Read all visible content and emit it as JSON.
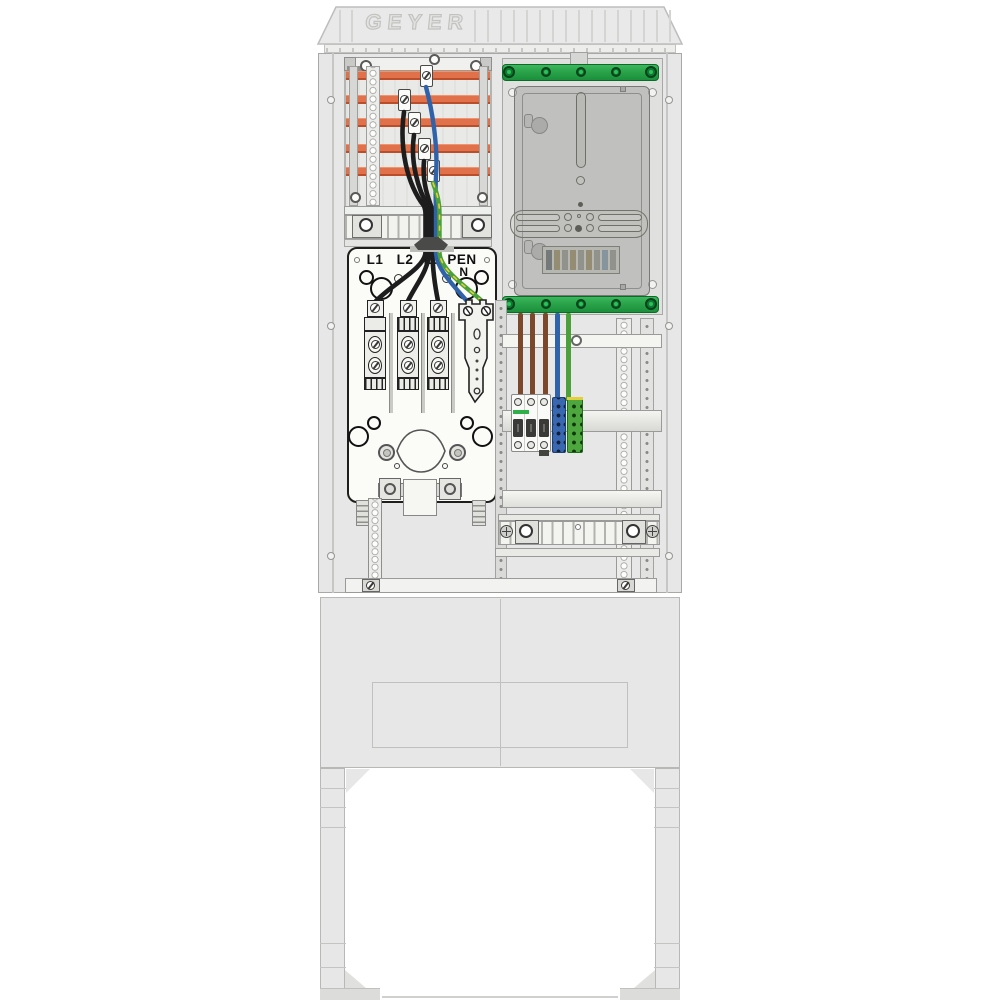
{
  "brand": {
    "logo_text": "GEYER"
  },
  "distribution_block": {
    "labels": {
      "l1": "L1",
      "l2": "L2",
      "l3": "L3",
      "pen": "PEN",
      "n": "N"
    },
    "fuse_rail_count": 3
  },
  "supply_section": {
    "busbar_count": 5,
    "tap_clamp_count": 5
  },
  "meter": {
    "rail_screw_count": 5,
    "terminal_stripe_colors": [
      "#5d666a",
      "#97865f",
      "#8f9088",
      "#97865f",
      "#8f9088",
      "#97865f",
      "#8f9088",
      "#7d93a6",
      "#8f9088"
    ]
  },
  "outgoing_section": {
    "breaker_pole_count": 3,
    "din_terminal_count": 2
  },
  "wires": {
    "supply": [
      "black",
      "black",
      "black",
      "blue",
      "green-yellow"
    ],
    "outgoing": [
      "brown",
      "brown",
      "brown",
      "blue",
      "green"
    ]
  },
  "colors": {
    "busbar": "#e0714a",
    "busbar-dark": "#ba4e2b",
    "rail-green": "#2aa34a",
    "rail-green-dark": "#0d6b28",
    "wire-black": "#1d1d1d",
    "wire-blue": "#2f62a8",
    "wire-green": "#4aa03a",
    "wire-yellow": "#e3cf3a",
    "wire-brown": "#7c482b",
    "terminal-blue": "#3a68b0",
    "terminal-green": "#4ea63e",
    "breaker-green": "#2fae4a"
  }
}
